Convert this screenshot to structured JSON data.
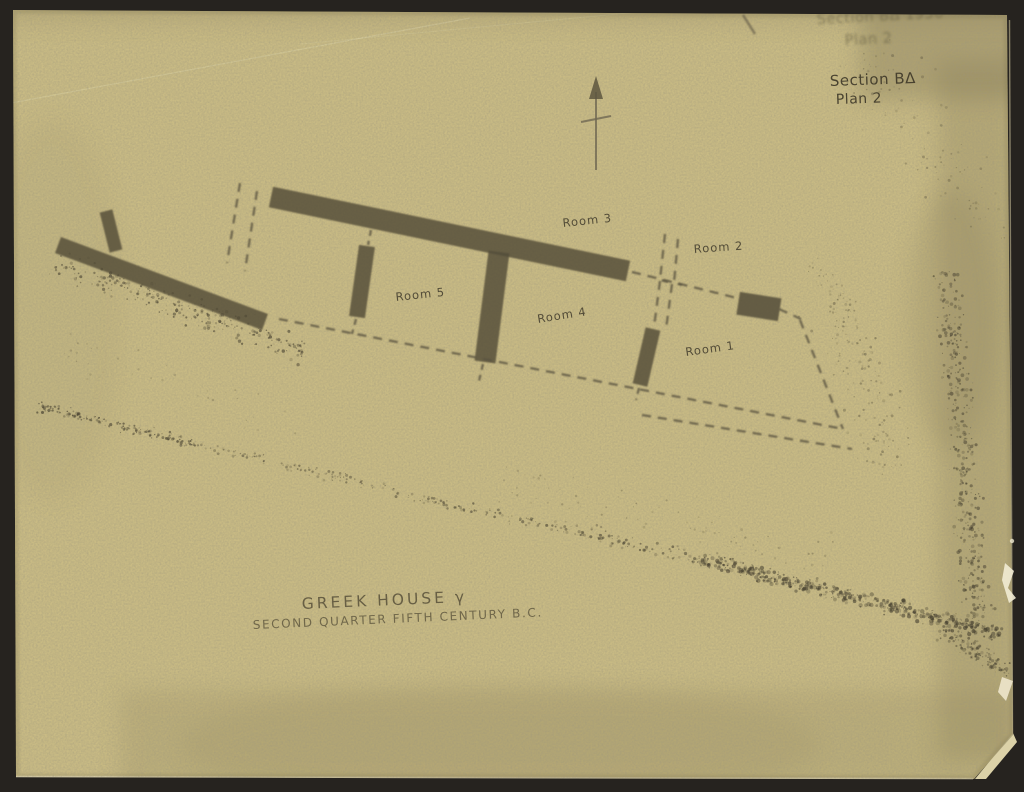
{
  "colors": {
    "background": "#26231f",
    "paper": "#c9bb84",
    "ink": "#534c38",
    "pen_note": "#433d2c"
  },
  "icons": {
    "north_arrow": "north-arrow-icon"
  },
  "annotations": {
    "stamp": {
      "line1": "Section BΔ 1950",
      "line2": "Plan 2"
    },
    "note": {
      "line1": "Section BΔ",
      "line2": "Plan 2"
    }
  },
  "plan": {
    "room_labels": [
      "Room 3",
      "Room 2",
      "Room 5",
      "Room 4",
      "Room 1"
    ]
  },
  "caption": {
    "line1": "GREEK HOUSE γ",
    "line2": "SECOND QUARTER FIFTH CENTURY B.C."
  }
}
